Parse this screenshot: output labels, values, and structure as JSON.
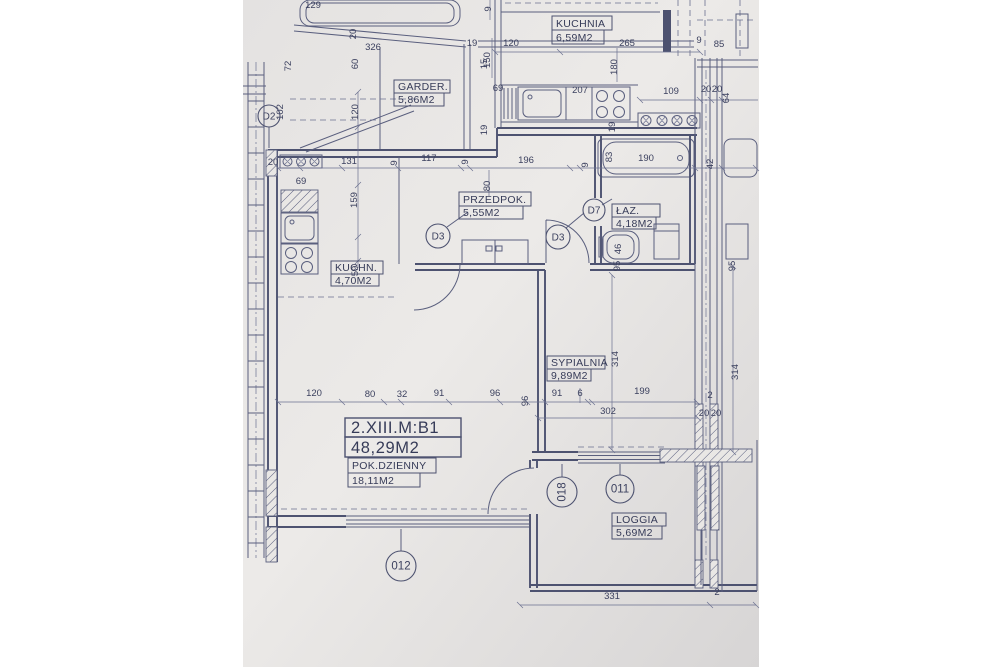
{
  "title_block": {
    "unit_id": "2.XIII.M:B1",
    "unit_area": "48,29M2"
  },
  "rooms": [
    {
      "name": "KUCHNIA",
      "area": "6,59M2"
    },
    {
      "name": "GARDER.",
      "area": "5,86M2"
    },
    {
      "name": "PRZEDPOK.",
      "area": "5,55M2"
    },
    {
      "name": "ŁAZ.",
      "area": "4,18M2"
    },
    {
      "name": "KUCHN.",
      "area": "4,70M2"
    },
    {
      "name": "SYPIALNIA",
      "area": "9,89M2"
    },
    {
      "name": "POK.DZIENNY",
      "area": "18,11M2"
    },
    {
      "name": "LOGGIA",
      "area": "5,69M2"
    }
  ],
  "symbols": {
    "doors": [
      {
        "id": "D2",
        "x": 269,
        "y": 116,
        "r": 11
      },
      {
        "id": "D3",
        "x": 438,
        "y": 236,
        "r": 12
      },
      {
        "id": "D3",
        "x": 558,
        "y": 237,
        "r": 12
      },
      {
        "id": "D7",
        "x": 594,
        "y": 210,
        "r": 11
      }
    ],
    "windows": [
      {
        "id": "018",
        "x": 562,
        "y": 492,
        "r": 15,
        "rot": true
      },
      {
        "id": "011",
        "x": 620,
        "y": 489,
        "r": 14
      },
      {
        "id": "012",
        "x": 401,
        "y": 566,
        "r": 15
      }
    ]
  },
  "dimensions": [
    {
      "t": "9",
      "x": 491,
      "y": 9,
      "r": -90
    },
    {
      "t": "129",
      "x": 313,
      "y": 8,
      "r": 0
    },
    {
      "t": "120",
      "x": 511,
      "y": 46,
      "r": 0
    },
    {
      "t": "265",
      "x": 627,
      "y": 46,
      "r": 0
    },
    {
      "t": "19",
      "x": 472,
      "y": 46,
      "r": 0
    },
    {
      "t": "150",
      "x": 490,
      "y": 60,
      "r": -90
    },
    {
      "t": "20",
      "x": 356,
      "y": 34,
      "r": -90
    },
    {
      "t": "326",
      "x": 373,
      "y": 50,
      "r": 0
    },
    {
      "t": "60",
      "x": 358,
      "y": 64,
      "r": -90
    },
    {
      "t": "15",
      "x": 487,
      "y": 64,
      "r": -90
    },
    {
      "t": "180",
      "x": 617,
      "y": 67,
      "r": -90
    },
    {
      "t": "102",
      "x": 283,
      "y": 112,
      "r": -90
    },
    {
      "t": "72",
      "x": 291,
      "y": 66,
      "r": -90
    },
    {
      "t": "207",
      "x": 580,
      "y": 93,
      "r": 0
    },
    {
      "t": "109",
      "x": 671,
      "y": 94,
      "r": 0
    },
    {
      "t": "20",
      "x": 706,
      "y": 92,
      "r": 0
    },
    {
      "t": "20",
      "x": 717,
      "y": 92,
      "r": 0
    },
    {
      "t": "64",
      "x": 729,
      "y": 98,
      "r": -90
    },
    {
      "t": "9",
      "x": 699,
      "y": 43,
      "r": 0
    },
    {
      "t": "85",
      "x": 719,
      "y": 47,
      "r": 0
    },
    {
      "t": "69",
      "x": 498,
      "y": 91,
      "r": 0
    },
    {
      "t": "120",
      "x": 358,
      "y": 112,
      "r": -90
    },
    {
      "t": "19",
      "x": 487,
      "y": 130,
      "r": -90
    },
    {
      "t": "19",
      "x": 615,
      "y": 127,
      "r": -90
    },
    {
      "t": "20",
      "x": 273,
      "y": 165,
      "r": 0
    },
    {
      "t": "131",
      "x": 349,
      "y": 164,
      "r": 0
    },
    {
      "t": "69",
      "x": 301,
      "y": 184,
      "r": 0
    },
    {
      "t": "9",
      "x": 397,
      "y": 163,
      "r": -90
    },
    {
      "t": "117",
      "x": 429,
      "y": 161,
      "r": 0
    },
    {
      "t": "9",
      "x": 468,
      "y": 162,
      "r": -90
    },
    {
      "t": "196",
      "x": 526,
      "y": 163,
      "r": 0
    },
    {
      "t": "9",
      "x": 588,
      "y": 165,
      "r": -90
    },
    {
      "t": "83",
      "x": 612,
      "y": 157,
      "r": -90
    },
    {
      "t": "190",
      "x": 646,
      "y": 161,
      "r": 0
    },
    {
      "t": "42",
      "x": 713,
      "y": 164,
      "r": -90
    },
    {
      "t": "80",
      "x": 490,
      "y": 186,
      "r": -90
    },
    {
      "t": "159",
      "x": 357,
      "y": 200,
      "r": -90
    },
    {
      "t": "59",
      "x": 358,
      "y": 271,
      "r": -90
    },
    {
      "t": "46",
      "x": 621,
      "y": 249,
      "r": -90
    },
    {
      "t": "95",
      "x": 620,
      "y": 266,
      "r": -90
    },
    {
      "t": "95",
      "x": 735,
      "y": 266,
      "r": -90
    },
    {
      "t": "314",
      "x": 618,
      "y": 359,
      "r": -90
    },
    {
      "t": "314",
      "x": 738,
      "y": 372,
      "r": -90
    },
    {
      "t": "120",
      "x": 314,
      "y": 396,
      "r": 0
    },
    {
      "t": "80",
      "x": 370,
      "y": 397,
      "r": 0
    },
    {
      "t": "32",
      "x": 402,
      "y": 397,
      "r": 0
    },
    {
      "t": "91",
      "x": 439,
      "y": 396,
      "r": 0
    },
    {
      "t": "96",
      "x": 495,
      "y": 396,
      "r": 0
    },
    {
      "t": "96",
      "x": 528,
      "y": 401,
      "r": -90
    },
    {
      "t": "91",
      "x": 557,
      "y": 396,
      "r": 0
    },
    {
      "t": "6",
      "x": 580,
      "y": 396,
      "r": 0
    },
    {
      "t": "199",
      "x": 642,
      "y": 394,
      "r": 0
    },
    {
      "t": "302",
      "x": 608,
      "y": 414,
      "r": 0
    },
    {
      "t": "20",
      "x": 704,
      "y": 416,
      "r": 0
    },
    {
      "t": "20",
      "x": 716,
      "y": 416,
      "r": 0
    },
    {
      "t": "2",
      "x": 710,
      "y": 398,
      "r": 0
    },
    {
      "t": "331",
      "x": 612,
      "y": 599,
      "r": 0
    },
    {
      "t": "2",
      "x": 717,
      "y": 595,
      "r": 0
    }
  ],
  "colors": {
    "ink": "#4d5270",
    "paper": "#e9e7e5"
  }
}
